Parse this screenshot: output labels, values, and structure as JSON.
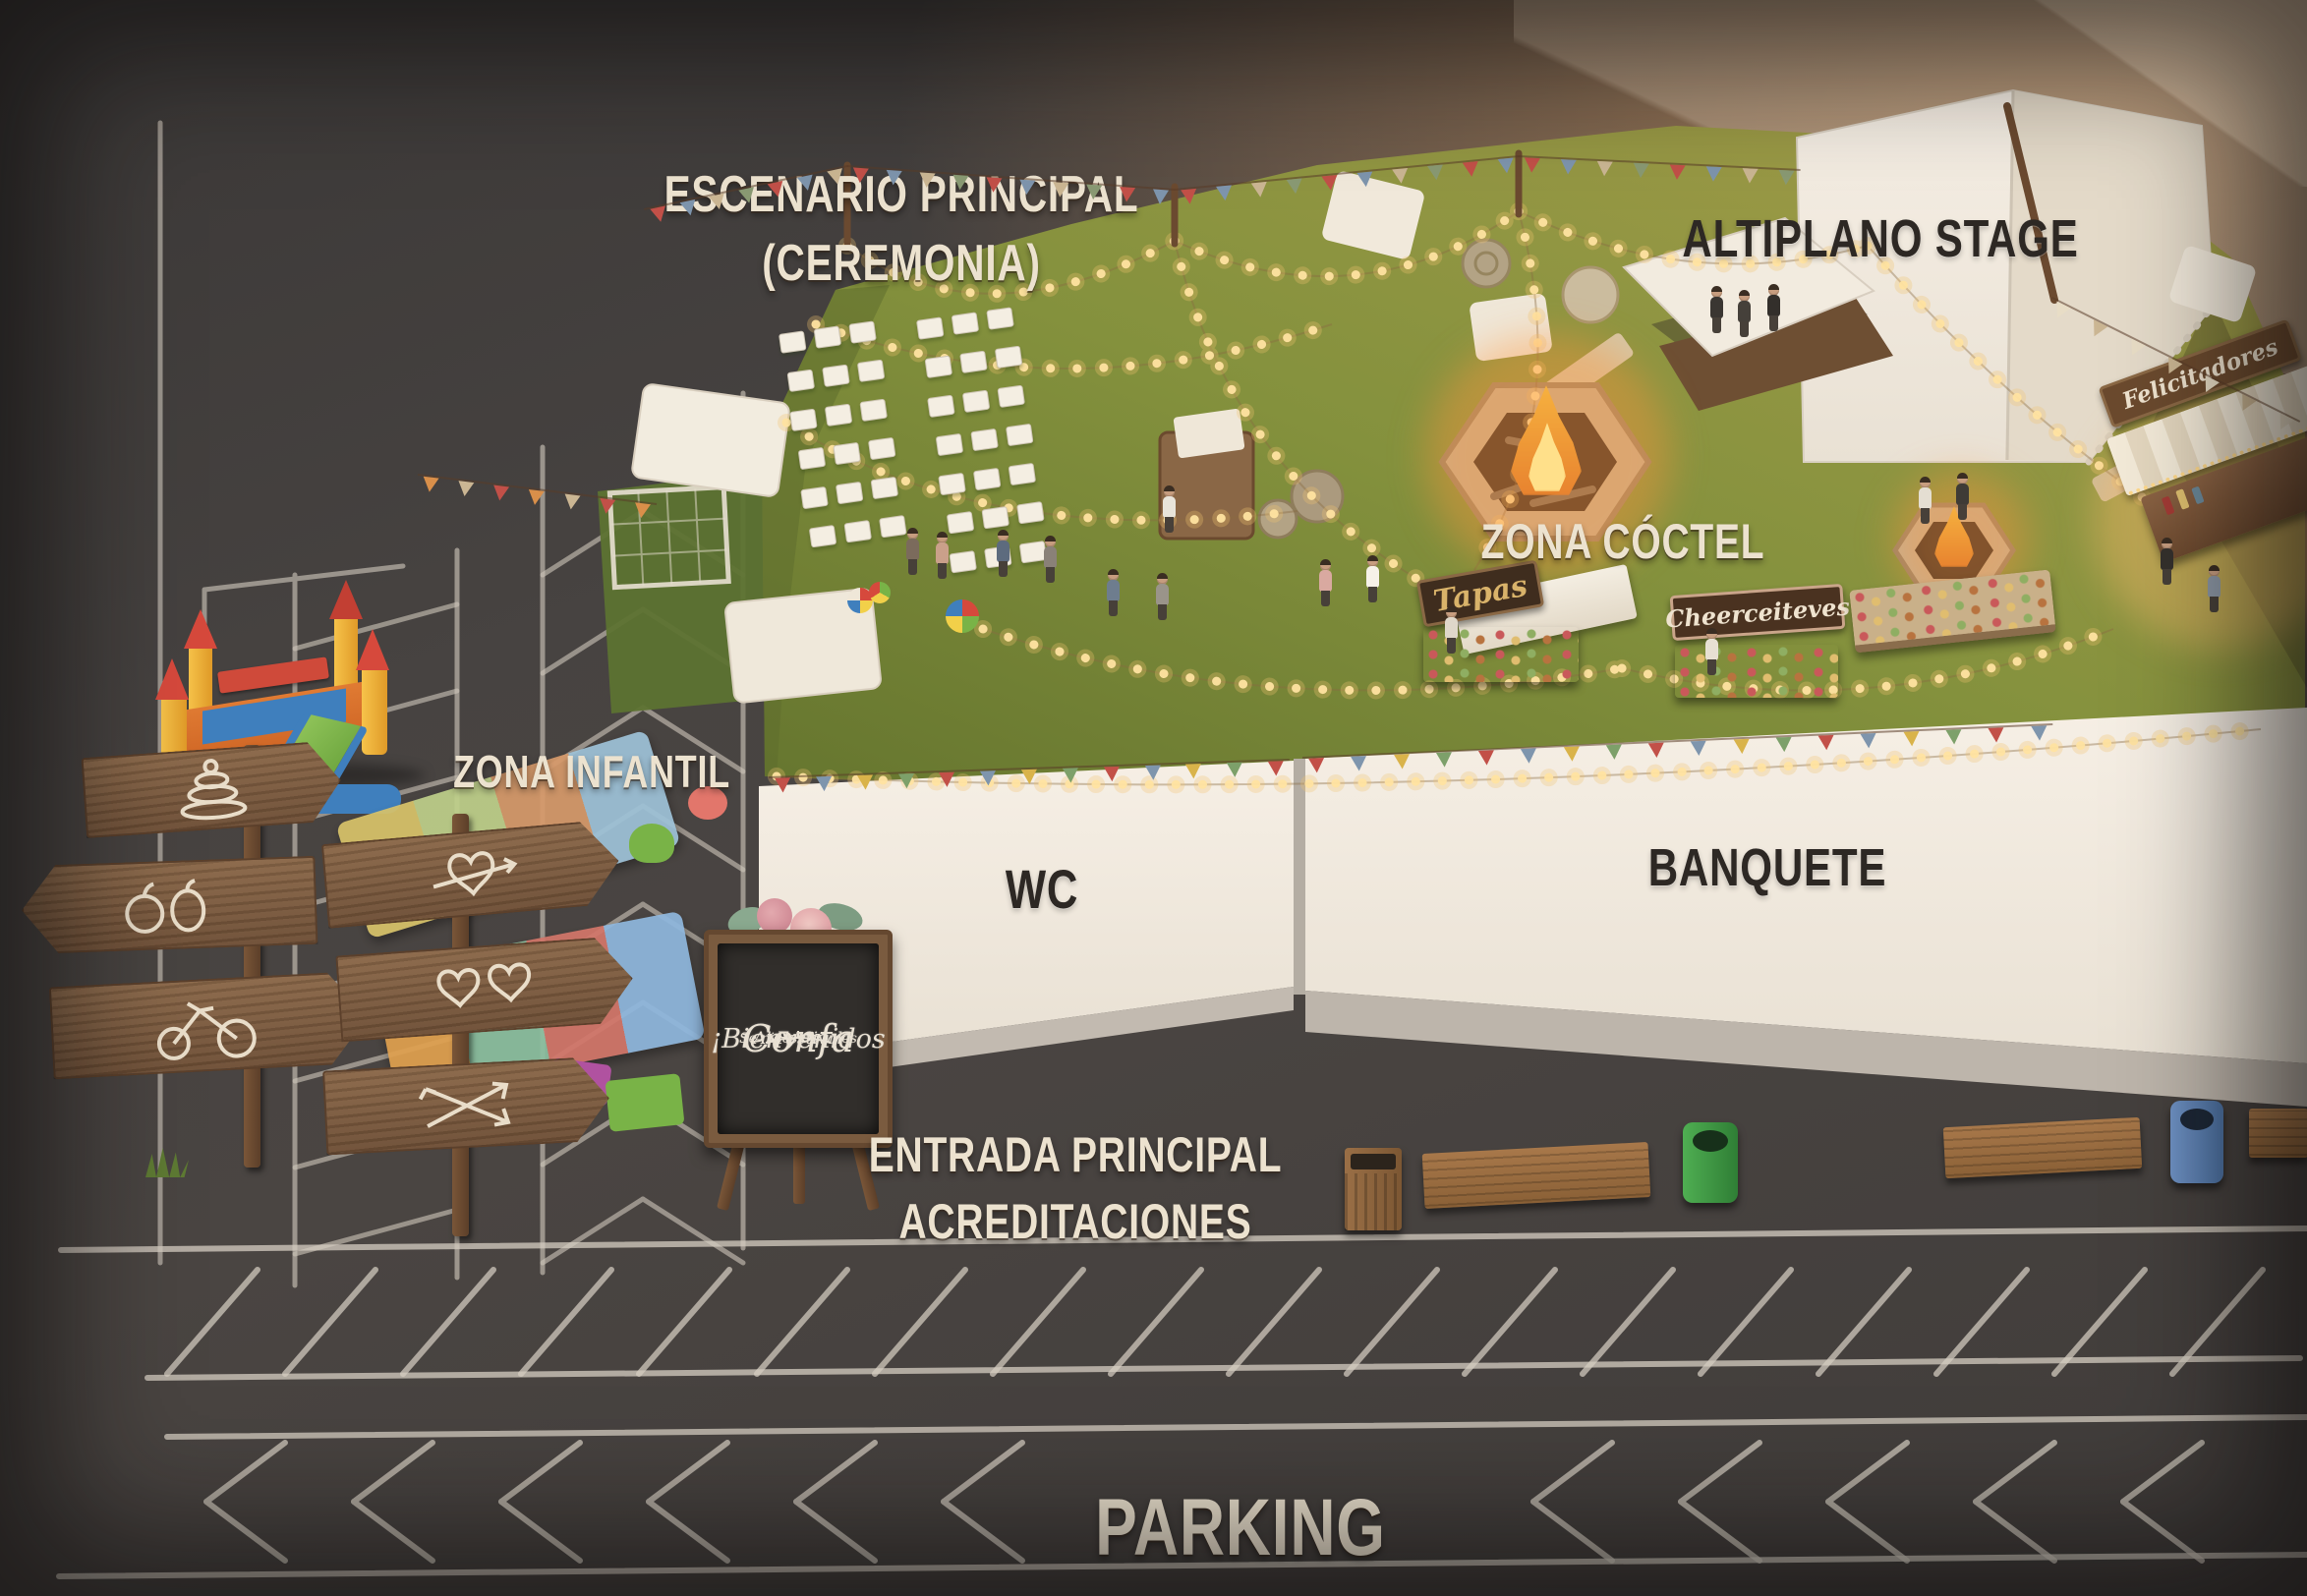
{
  "scene": {
    "description": "Illustrated aerial map of the Festival Confa wedding-festival venue at dusk: green lawn with string lights surrounded by dark asphalt parking with chalk markings",
    "features": [
      "bouncy-castle",
      "soccer-goal",
      "signpost-arrows",
      "play-mats",
      "foam-blocks",
      "welcome-chalkboard",
      "ceremony-chairs",
      "string-lights",
      "bunting-flags",
      "fire-pit-large",
      "fire-pit-small",
      "tapas-stall",
      "dessert-stall",
      "greetings-booth",
      "buffet-table",
      "hay-bales",
      "picnic-blankets",
      "mini-tents",
      "stage-canopy",
      "benches",
      "trash-bins",
      "parking-lines",
      "people"
    ]
  },
  "labels": {
    "main_stage_line1": "ESCENARIO PRINCIPAL",
    "main_stage_line2": "(CEREMONIA)",
    "altiplano_stage": "ALTIPLANO STAGE",
    "cocktail_zone": "ZONA CÓCTEL",
    "kids_zone": "ZONA INFANTIL",
    "wc": "WC",
    "banquet": "BANQUETE",
    "entrance_line1": "ENTRADA PRINCIPAL",
    "entrance_line2": "ACREDITACIONES",
    "parking": "PARKING"
  },
  "stalls": {
    "tapas": "Tapas",
    "desserts": "Cheerceiteves",
    "greetings_booth": "Felicitadores"
  },
  "welcome_board": {
    "line1": "¡Bienvenidos",
    "line2": "Al Festival",
    "line3": "Confa",
    "line4": "Se nices do tmes"
  },
  "palette": {
    "asphalt": "#454140",
    "grass": "#7f8d3c",
    "tent_white": "#f2ebe0",
    "chalk": "#d6cec2",
    "label_cream": "#ece2cf",
    "label_dark": "#2d2824",
    "wood": "#7b5a3e",
    "sign_dark": "#3f2d1e",
    "gold_script": "#d9b36a",
    "string_light": "#ffe3a1",
    "fire": "#f6a93b",
    "bunting_red": "#c25048",
    "bunting_blue": "#7e95ad",
    "bunting_tan": "#cbb693",
    "castle_yellow": "#f2b234",
    "castle_red": "#d6493c",
    "castle_orange": "#e07b33",
    "castle_blue": "#3f7fbd",
    "castle_green": "#79b347",
    "bin_green": "#3f9a44",
    "bin_blue": "#5b7fb5"
  }
}
